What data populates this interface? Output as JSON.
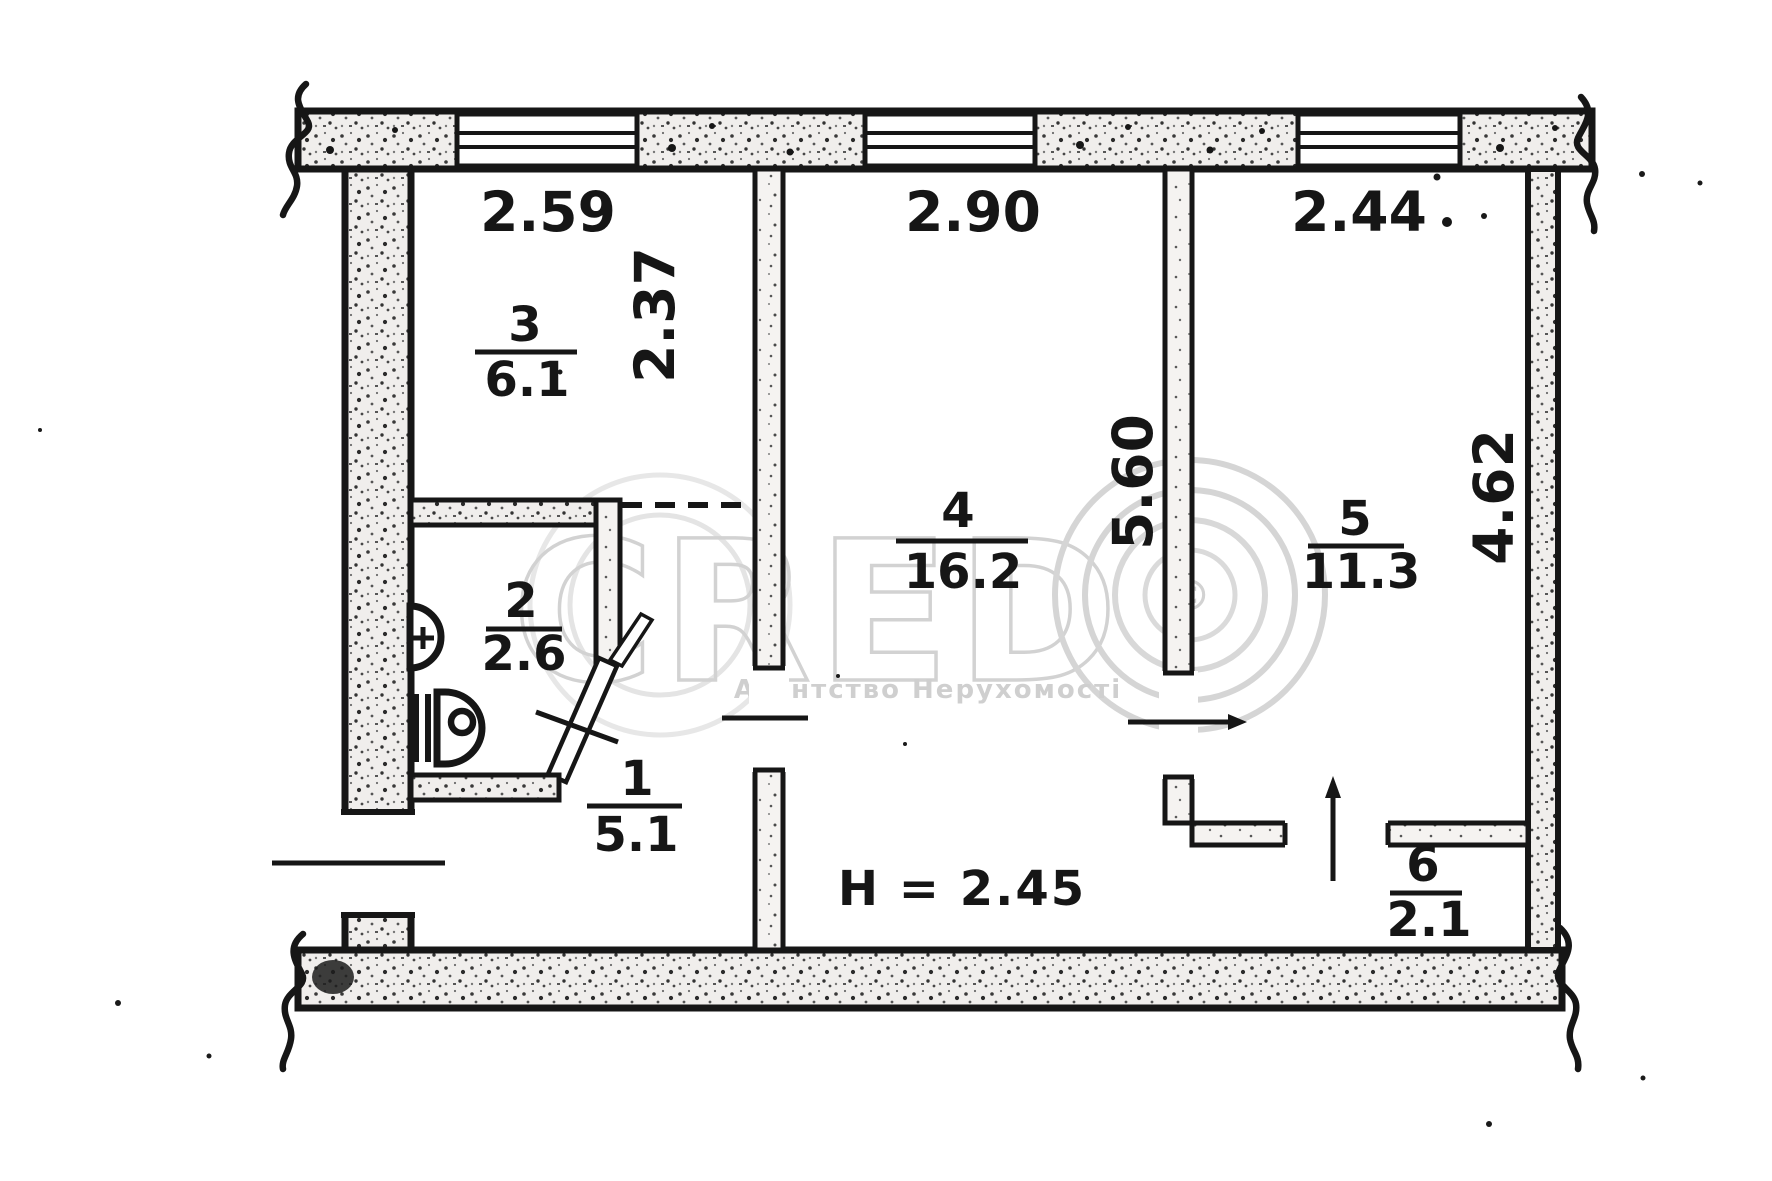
{
  "plan": {
    "rooms": [
      {
        "number": "1",
        "area": "5.1"
      },
      {
        "number": "2",
        "area": "2.6"
      },
      {
        "number": "3",
        "area": "6.1"
      },
      {
        "number": "4",
        "area": "16.2"
      },
      {
        "number": "5",
        "area": "11.3"
      },
      {
        "number": "6",
        "area": "2.1"
      }
    ],
    "dimensions": {
      "window_left": "2.59",
      "window_middle": "2.90",
      "window_right": "2.44",
      "room3_depth": "2.37",
      "center_wall": "5.60",
      "right_wall": "4.62"
    },
    "ceiling_height": "H = 2.45"
  },
  "watermark": {
    "brand": "CRED",
    "symbol": "©",
    "caption": "Агентство Нерухомості"
  },
  "colors": {
    "ink": "#161616",
    "watermark_gray": "#d2d2d2"
  }
}
